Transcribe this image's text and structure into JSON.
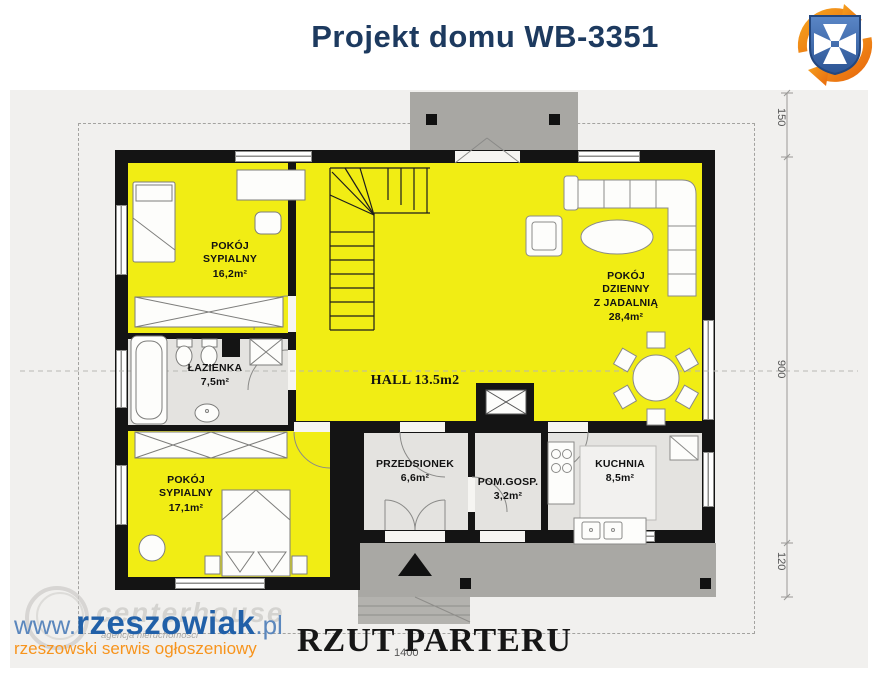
{
  "header": {
    "title": "Projekt domu WB-3351"
  },
  "logo": {
    "name": "rzeszow-crest-logo",
    "shield_color": "#3a66ad",
    "cross_color": "#ffffff",
    "arrow_color": "#f08a1d"
  },
  "plan": {
    "rooms": [
      {
        "id": "bedroom-1",
        "lines": [
          "POKÓJ",
          "SYPIALNY"
        ],
        "area": "16,2m²"
      },
      {
        "id": "bathroom",
        "lines": [
          "ŁAZIENKA"
        ],
        "area": "7,5m²"
      },
      {
        "id": "bedroom-2",
        "lines": [
          "POKÓJ",
          "SYPIALNY"
        ],
        "area": "17,1m²"
      },
      {
        "id": "hall",
        "label": "HALL 13.5m2"
      },
      {
        "id": "living-dining",
        "lines": [
          "POKÓJ",
          "DZIENNY",
          "Z JADALNIĄ"
        ],
        "area": "28,4m²"
      },
      {
        "id": "vestibule",
        "lines": [
          "PRZEDSIONEK"
        ],
        "area": "6,6m²"
      },
      {
        "id": "utility",
        "lines": [
          "POM.GOSP."
        ],
        "area": "3,2m²"
      },
      {
        "id": "kitchen",
        "lines": [
          "KUCHNIA"
        ],
        "area": "8,5m²"
      }
    ],
    "dimensions": {
      "right": [
        "150",
        "900",
        "120"
      ],
      "bottom": "1400"
    },
    "colors": {
      "room_yellow": "#f1ed14",
      "floor_gray": "#e4e3e0",
      "wall_black": "#141414",
      "terrace_gray": "#a9a8a4",
      "plan_background": "#f1f0ee",
      "title_navy": "#1d3a5f"
    }
  },
  "footer": {
    "plan_label": "RZUT PARTERU"
  },
  "watermark": {
    "url_prefix": "www.",
    "brand": "rzeszowiak",
    "url_suffix": ".pl",
    "tagline": "rzeszowski serwis ogłoszeniowy",
    "ghost_brand": "centerhouse",
    "ghost_sub": "agencja nieruchomości"
  }
}
